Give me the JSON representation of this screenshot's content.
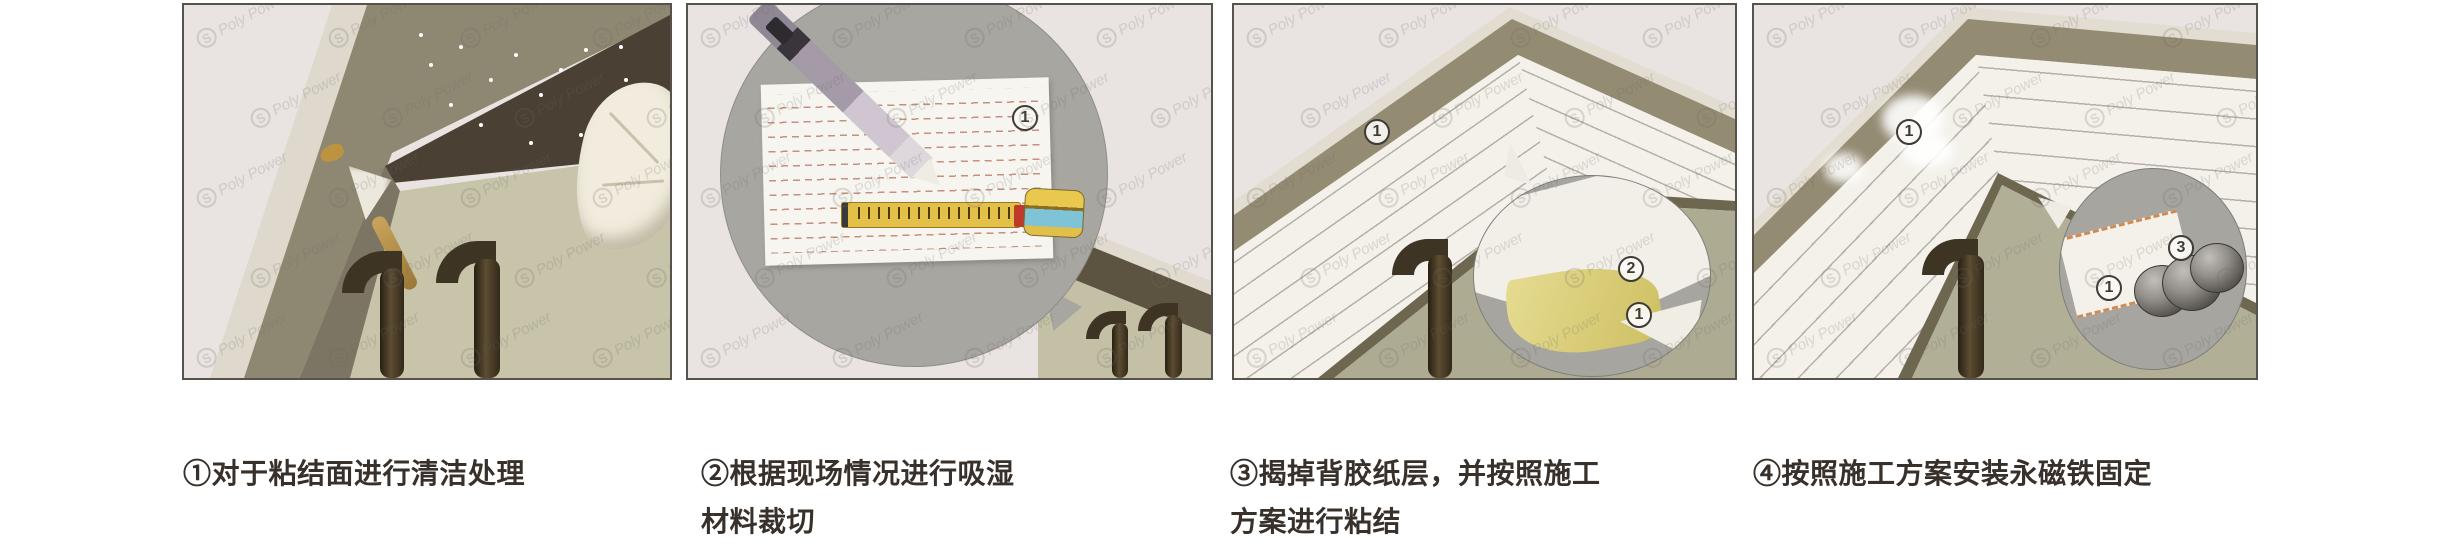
{
  "figure": {
    "background": "#ffffff",
    "watermark": {
      "logo_letter": "S",
      "brand": "Poly Power"
    },
    "steps": [
      {
        "caption": [
          "①对于粘结面进行清洁处理"
        ],
        "labels": {}
      },
      {
        "caption": [
          "②根据现场情况进行吸湿",
          "材料裁切"
        ],
        "labels": {
          "sheet": "1"
        }
      },
      {
        "caption": [
          "③揭掉背胶纸层，并按照施工",
          "方案进行粘结"
        ],
        "labels": {
          "strip": "1",
          "peel": "2",
          "backing": "1"
        }
      },
      {
        "caption": [
          "④按照施工方案安装永磁铁固定"
        ],
        "labels": {
          "strip": "1",
          "sheet": "1",
          "magnets": "3"
        }
      }
    ],
    "colors": {
      "paper": "#e9e3e1",
      "frame_olive": "#8e8771",
      "ceiling_dark": "#4a4134",
      "wall_green": "#c7c4aa",
      "strip_white": "#f3f1ea",
      "bubble_gray": "#a7a5a0",
      "tape_yellow": "#e3c048",
      "case_blue": "#7fc3d6",
      "adhesive_yellow": "#ddd07a",
      "pipe_brown": "#3e3424",
      "dash_red": "#bb8a7c",
      "label_ink": "#3f3a33",
      "caption_ink": "#38302a"
    }
  }
}
